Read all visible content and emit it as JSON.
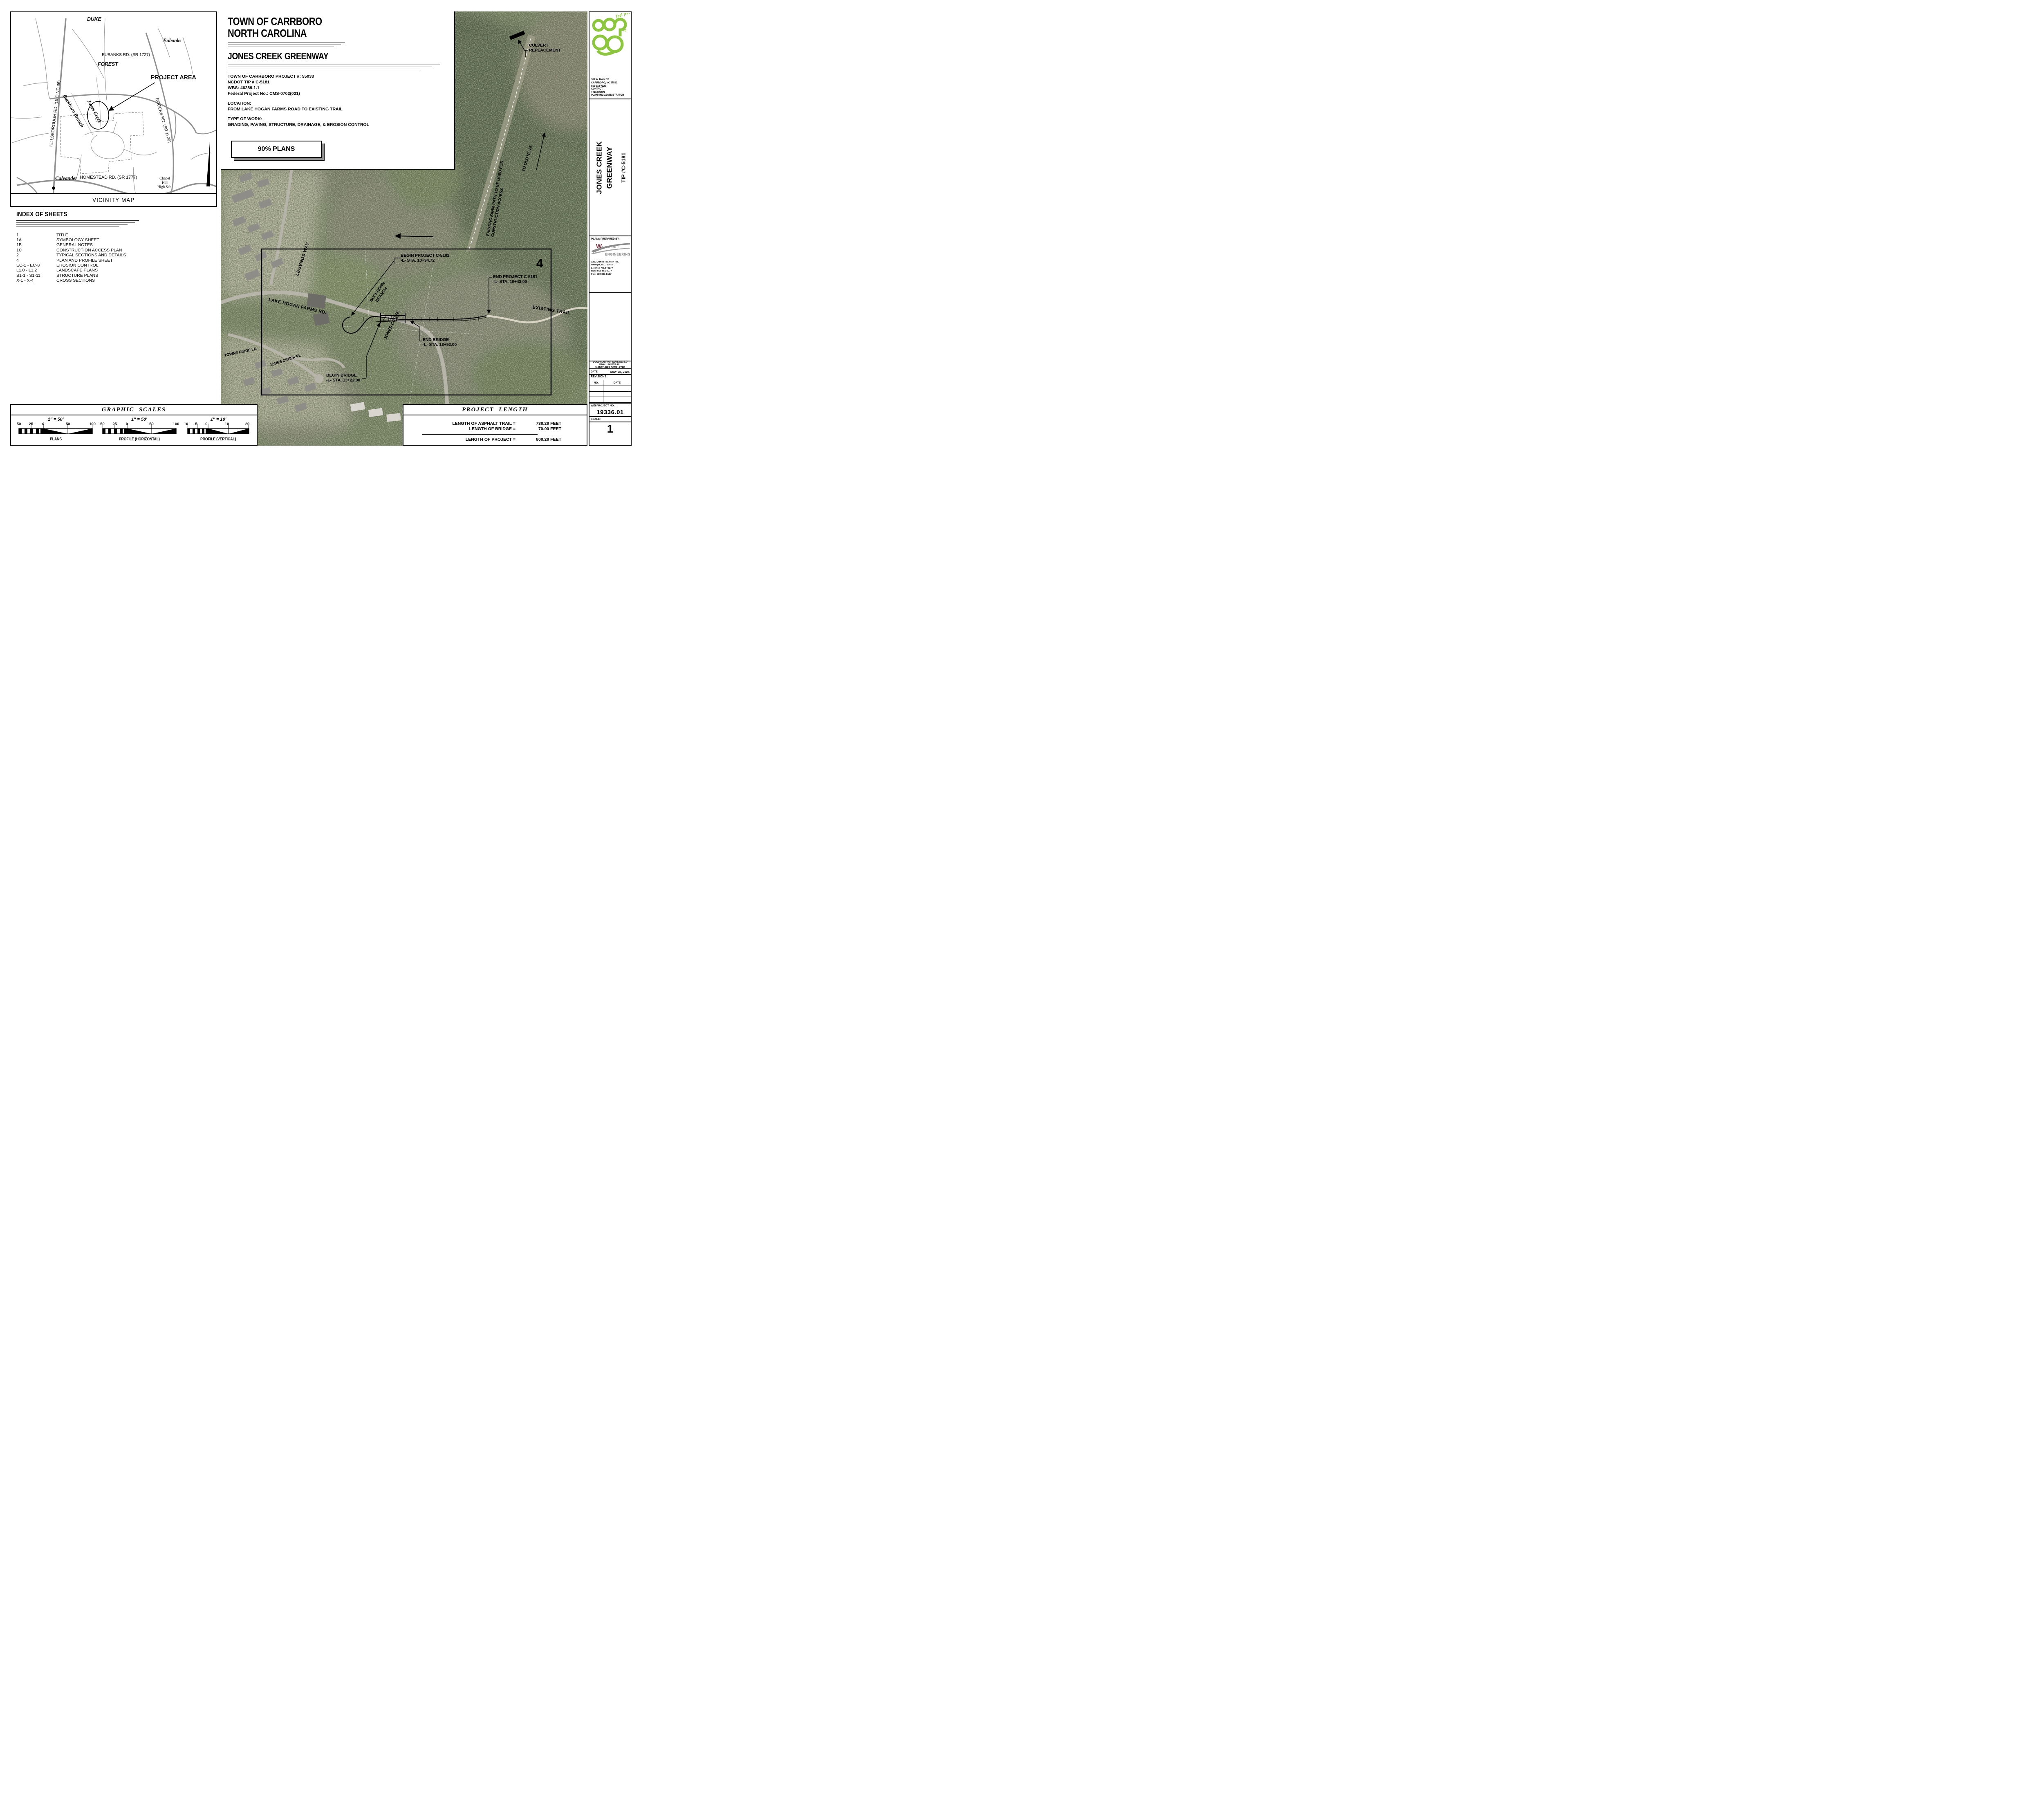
{
  "colors": {
    "carrboro_green": "#8cc63f",
    "wetherill_maroon": "#7a3342",
    "wetherill_gray": "#8a8a8a",
    "map_road_gray": "#909090"
  },
  "title_block": {
    "town_line1": "TOWN OF CARRBORO",
    "town_line2": "NORTH CAROLINA",
    "project_title": "JONES CREEK GREENWAY",
    "project_number": "TOWN OF CARRBORO PROJECT #: 55033",
    "ncdot_tip": "NCDOT TIP # C-5181",
    "wbs": "WBS: 46289.1.1",
    "federal_project": "Federal Project No.: CMS-0702(021)",
    "location_label": "LOCATION:",
    "location_value": "FROM LAKE HOGAN FARMS ROAD TO EXISTING TRAIL",
    "type_of_work_label": "TYPE OF WORK:",
    "type_of_work_value": "GRADING, PAVING, STRUCTURE, DRAINAGE, & EROSION CONTROL",
    "plans_stage": "90% PLANS"
  },
  "vicinity_map": {
    "title": "VICINITY MAP",
    "labels": {
      "duke": "DUKE",
      "forest": "FOREST",
      "eubanks": "Eubanks",
      "eubanks_rd": "EUBANKS RD. (SR 1727)",
      "project_area": "PROJECT AREA",
      "rogers_rd": "ROGERS RD. (SR 1729)",
      "hillsborough_rd": "HILLSBOROUGH RD. (OLD NC 86)",
      "jones_creek": "Jones Creek",
      "buckhorn_branch": "Buckhorn Branch",
      "calvander": "Calvander",
      "homestead_rd": "HOMESTEAD RD. (SR 1777)",
      "chapel_hill_high": "Chapel\nHill\nHigh Sch."
    }
  },
  "index_of_sheets": {
    "title": "INDEX OF SHEETS",
    "rows": [
      {
        "no": "1",
        "name": "TITLE"
      },
      {
        "no": "1A",
        "name": "SYMBOLOGY SHEET"
      },
      {
        "no": "1B",
        "name": "GENERAL NOTES"
      },
      {
        "no": "1C",
        "name": "CONSTRUCTION ACCESS PLAN"
      },
      {
        "no": "2",
        "name": "TYPICAL SECTIONS AND DETAILS"
      },
      {
        "no": "4",
        "name": "PLAN AND PROFILE SHEET"
      },
      {
        "no": "EC-1 - EC-8",
        "name": "EROSION CONTROL"
      },
      {
        "no": "L1.0 - L1.2",
        "name": "LANDSCAPE PLANS"
      },
      {
        "no": "S1-1 - S1-11",
        "name": "STRUCTURE PLANS"
      },
      {
        "no": "X-1 - X-4",
        "name": "CROSS SECTIONS"
      }
    ]
  },
  "aerial": {
    "labels": {
      "culvert": "CULVERT\nREPLACEMENT",
      "farm_path": "EXISTING FARM PATH TO BE USED FOR CONSTRUCTION ACCESS.",
      "to_old_nc86": "TO OLD NC 86",
      "begin_project": "BEGIN PROJECT C-5181\n-L- STA. 10+34.72",
      "end_project": "END PROJECT C-5181\n-L- STA. 18+43.00",
      "begin_bridge": "BEGIN BRIDGE\n-L- STA. 13+22.00",
      "end_bridge": "END BRIDGE\n-L- STA. 13+92.00",
      "existing_trail": "EXISTING TRAIL",
      "lake_hogan_farms_rd": "LAKE HOGAN FARMS RD.",
      "legends_way": "LEGENDS WAY",
      "buckhorn_branch": "BUCKHORN\nBRANCH",
      "jones_creek": "JONES CREEK",
      "jones_creek_pl": "JONES CREEK PL",
      "towne_ridge_ln": "TOWNE RIDGE LN",
      "sheet_ref": "4"
    }
  },
  "sidebar": {
    "agency": {
      "logo_prefix": "It's",
      "logo_tagline": "feel free",
      "address_lines": "301 W. MAIN ST.\nCARRBORO, NC 27510\n919-918-7325\nCONTACT:\nTINA MOON\nPLANNING ADMINISTRATOR"
    },
    "project_title": {
      "line1": "JONES CREEK",
      "line2": "GREENWAY",
      "tip": "TIP #C-5181"
    },
    "prepared_by": {
      "label": "PLANS PREPARED BY:",
      "firm_line1": "WETHERILL",
      "firm_line2": "ENGINEERING",
      "address_lines": "1223 Jones Franklin Rd.\nRaleigh, N.C. 27606\nLicense No. F-0377\nBus:  919 851 8077\nFax:  919 851 8107"
    },
    "stamp": "DOCUMENT NOT CONSIDERED\nFINAL UNLESS ALL\nSIGNATURES COMPLETED",
    "date_label": "DATE:",
    "date_value": "MAY 28, 2025",
    "revisions_label": "REVISIONS:",
    "rev_col_no": "NO.",
    "rev_col_date": "DATE",
    "wei_label": "WEI PROJECT NO.:",
    "wei_value": "19336.01",
    "scale_label": "SCALE:",
    "sheet_number": "1"
  },
  "graphic_scales": {
    "title": "GRAPHIC  SCALES",
    "scales": [
      {
        "ratio": "1″ = 50′",
        "ticks": [
          "50",
          "25",
          "0",
          "50",
          "100"
        ],
        "caption": "PLANS"
      },
      {
        "ratio": "1″ = 50′",
        "ticks": [
          "50",
          "25",
          "0",
          "50",
          "100"
        ],
        "caption": "PROFILE  (HORIZONTAL)"
      },
      {
        "ratio": "1″ = 10′",
        "ticks": [
          "10",
          "5",
          "0",
          "10",
          "20"
        ],
        "caption": "PROFILE  (VERTICAL)"
      }
    ]
  },
  "project_length": {
    "title": "PROJECT  LENGTH",
    "rows": [
      {
        "label": "LENGTH OF ASPHALT TRAIL =",
        "value": "738.28 FEET"
      },
      {
        "label": "LENGTH OF BRIDGE =",
        "value": "70.00 FEET"
      }
    ],
    "total": {
      "label": "LENGTH OF PROJECT =",
      "value": "808.28 FEET"
    }
  }
}
